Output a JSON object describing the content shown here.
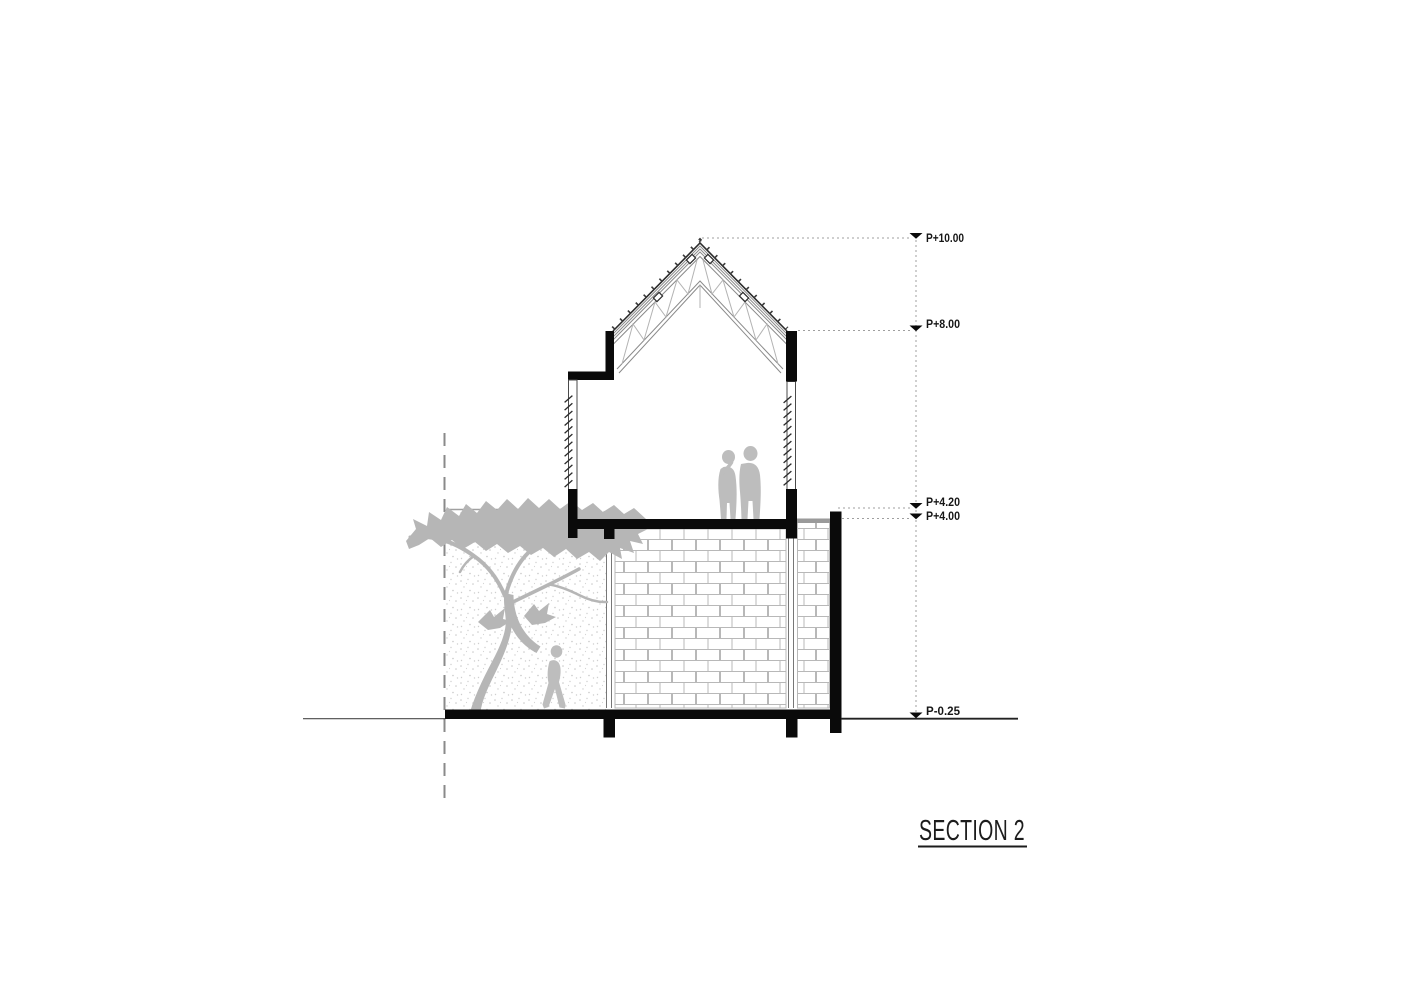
{
  "title": {
    "label": "SECTION 2"
  },
  "annotations": {
    "levels": [
      {
        "label": "P+10.00"
      },
      {
        "label": "P+8.00"
      },
      {
        "label": "P+4.20"
      },
      {
        "label": "P+4.00"
      },
      {
        "label": "P-0.25"
      }
    ]
  },
  "drawing": {
    "kind": "architectural cross-section",
    "elements": [
      "gable-roof-truss",
      "roof-batten-ticks",
      "upper-floor-room",
      "louvered-wall-left",
      "louvered-wall-right",
      "lower-floor-room",
      "brick-wall-elevation",
      "right-terrace",
      "right-boundary-wall",
      "ground-slab",
      "courtyard-tree",
      "stippled-background-wall",
      "two-people-upper-floor",
      "walking-person-courtyard",
      "property-dashed-line",
      "ground-line"
    ],
    "colors": {
      "ink": "#0a0a0a",
      "silhouette": "#bdbdbd",
      "brick_line": "#b8b8b8",
      "dim_line": "#9f9f9f",
      "text": "#161616"
    }
  }
}
